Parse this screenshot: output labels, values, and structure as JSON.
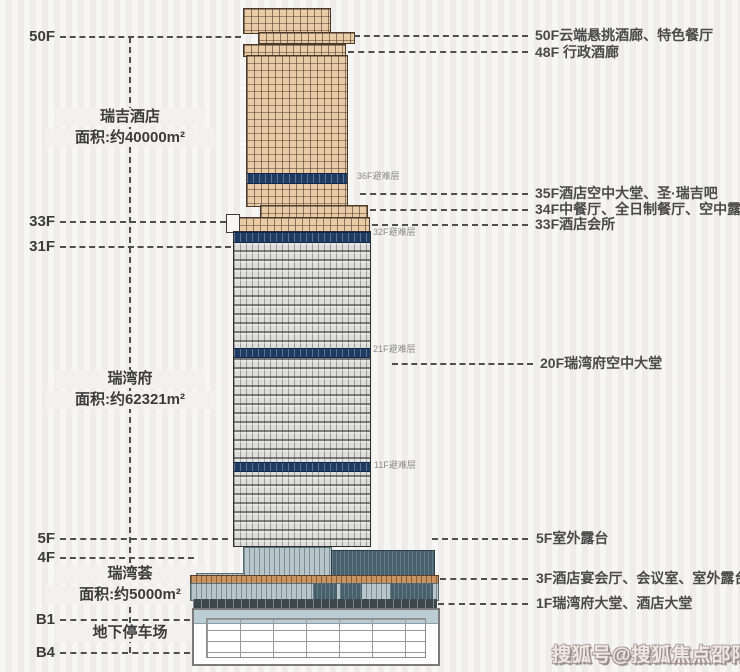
{
  "left_axis": {
    "floors": [
      {
        "label": "50F"
      },
      {
        "label": "33F"
      },
      {
        "label": "31F"
      },
      {
        "label": "5F"
      },
      {
        "label": "4F"
      },
      {
        "label": "B1"
      },
      {
        "label": "B4"
      }
    ]
  },
  "sections": [
    {
      "name": "瑞吉酒店",
      "area": "面积:约40000m²"
    },
    {
      "name": "瑞湾府",
      "area": "面积:约62321m²"
    },
    {
      "name": "瑞湾荟",
      "area": "面积:约5000m²"
    },
    {
      "name": "地下停车场",
      "area": ""
    }
  ],
  "right_annotations": [
    {
      "label": "50F云端悬挑酒廊、特色餐厅"
    },
    {
      "label": "48F 行政酒廊"
    },
    {
      "label": "35F酒店空中大堂、圣·瑞吉吧"
    },
    {
      "label": "34F中餐厅、全日制餐厅、空中露台"
    },
    {
      "label": "33F酒店会所"
    },
    {
      "label": "20F瑞湾府空中大堂"
    },
    {
      "label": "5F室外露台"
    },
    {
      "label": "3F酒店宴会厅、会议室、室外露台"
    },
    {
      "label": "1F瑞湾府大堂、酒店大堂"
    }
  ],
  "refuge_floors": [
    {
      "label": "36F避难层"
    },
    {
      "label": "32F避难层"
    },
    {
      "label": "21F避难层"
    },
    {
      "label": "11F避难层"
    }
  ],
  "watermark": "搜狐号@搜狐焦点邵阳站",
  "colors": {
    "tower_top": "#e9cba6",
    "tower_lower": "#dddddb",
    "refuge_band": "#1e3c63",
    "podium_glass": "#b8c6cb",
    "podium_wing": "#46616c",
    "canopy": "#c9945f",
    "background": "#f2f1ef"
  }
}
